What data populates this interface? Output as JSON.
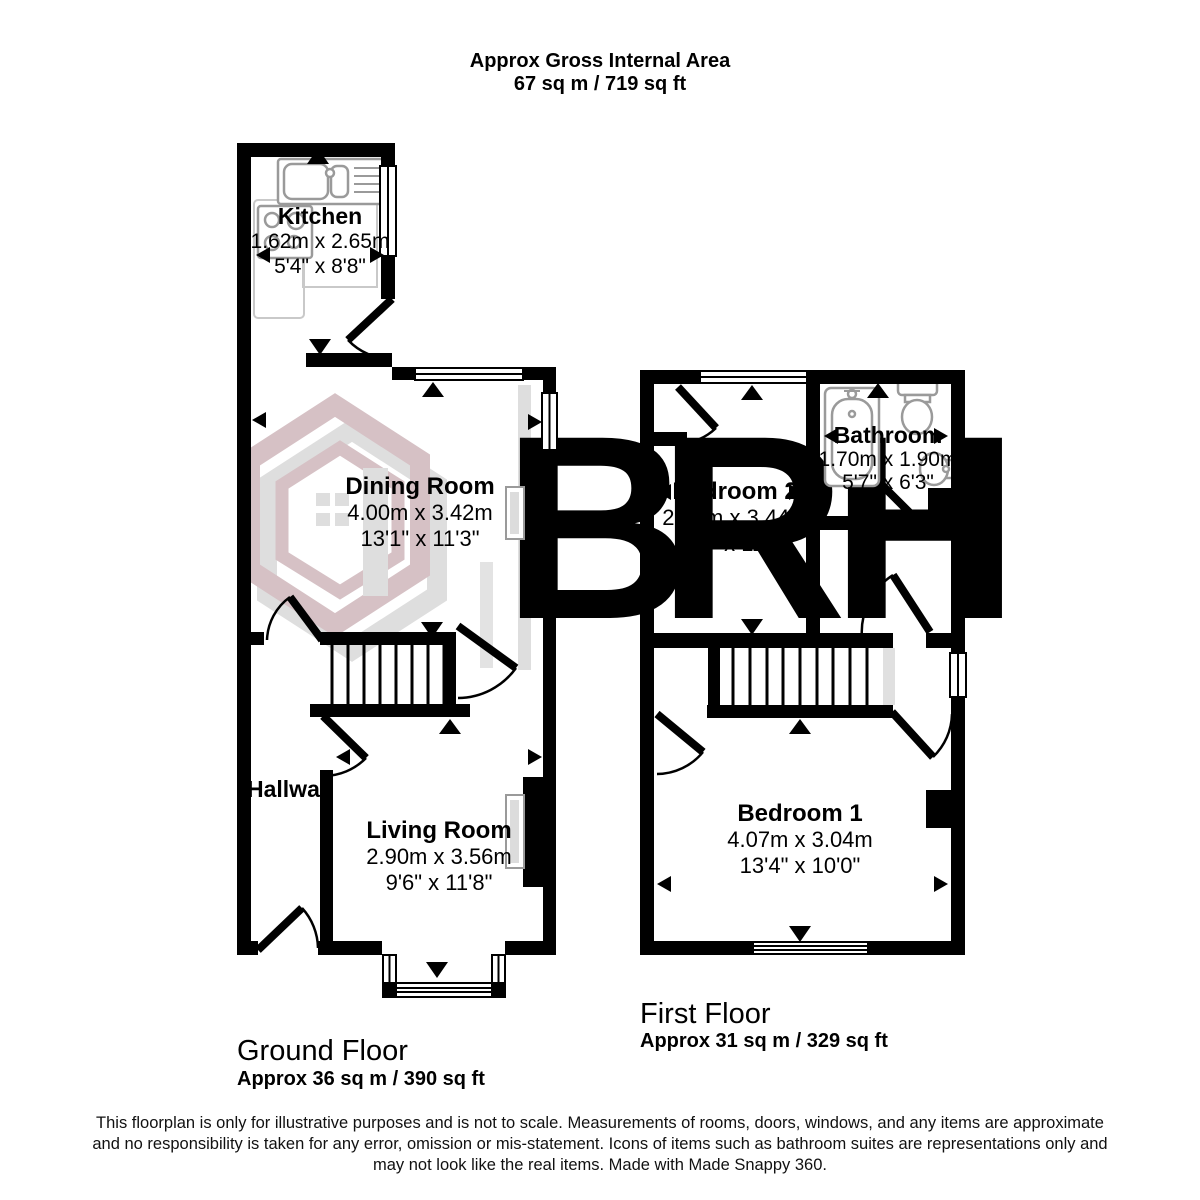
{
  "header": {
    "title": "Approx Gross Internal Area",
    "subtitle": "67 sq m / 719 sq ft"
  },
  "watermark": {
    "letter_b": "B",
    "letter_r": "R",
    "letter_h": "H",
    "pink": "#d6c1c5",
    "gray": "#dedede"
  },
  "ground_floor": {
    "label": "Ground Floor",
    "area": "Approx 36 sq m / 390 sq ft",
    "rooms": {
      "kitchen": {
        "name": "Kitchen",
        "metric": "1.62m x 2.65m",
        "imperial": "5'4\" x 8'8\""
      },
      "dining": {
        "name": "Dining Room",
        "metric": "4.00m x 3.42m",
        "imperial": "13'1\" x 11'3\""
      },
      "hallway": {
        "name": "Hallway"
      },
      "living": {
        "name": "Living Room",
        "metric": "2.90m x 3.56m",
        "imperial": "9'6\" x 11'8\""
      }
    }
  },
  "first_floor": {
    "label": "First Floor",
    "area": "Approx 31 sq m / 329 sq ft",
    "rooms": {
      "bedroom2": {
        "name": "Bedroom 2",
        "metric": "2.18m x 3.44m",
        "imperial": "7'2\" x 11'3\""
      },
      "bathroom": {
        "name": "Bathroom",
        "metric": "1.70m x 1.90m",
        "imperial": "5'7\" x 6'3\""
      },
      "bedroom1": {
        "name": "Bedroom 1",
        "metric": "4.07m x 3.04m",
        "imperial": "13'4\" x 10'0\""
      }
    }
  },
  "footer": {
    "line1": "This floorplan is only for illustrative purposes and is not to scale. Measurements of rooms, doors, windows, and any items are approximate",
    "line2": "and no responsibility is taken for any error, omission or mis-statement. Icons of items such as bathroom suites are representations only and",
    "line3": "may not look like the real items. Made with Made Snappy 360."
  }
}
